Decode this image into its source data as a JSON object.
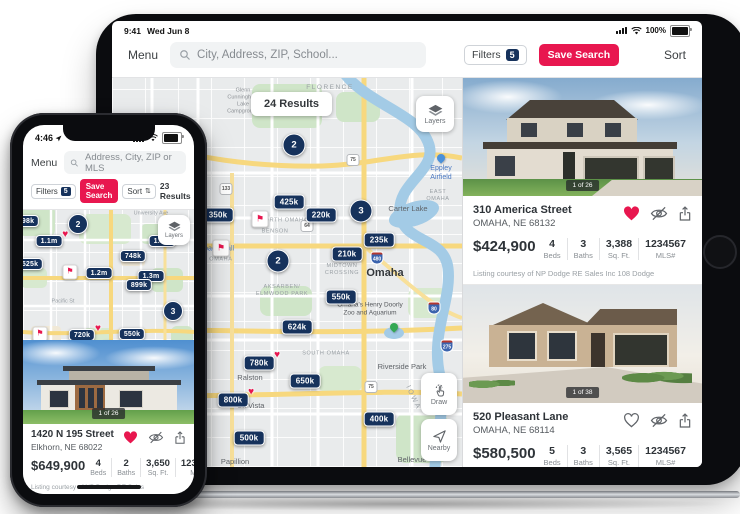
{
  "icons": {
    "sort_arrows": "⇅",
    "flag": "⚑",
    "heart": "♥"
  },
  "colors": {
    "navy": "#16325c",
    "red": "#e8174f",
    "map_water": "#a3cbe6",
    "map_highway": "#f7d87e"
  },
  "ipad": {
    "status": {
      "time": "9:41",
      "date": "Wed Jun 8",
      "battery_pct": "100%"
    },
    "nav": {
      "menu": "Menu",
      "search_placeholder": "City, Address, ZIP, School...",
      "filters": "Filters",
      "filters_count": "5",
      "save_search": "Save Search",
      "sort": "Sort"
    },
    "map": {
      "results": "24 Results",
      "layers": "Layers",
      "draw": "Draw",
      "nearby": "Nearby",
      "pins": [
        {
          "type": "cluster",
          "label": "2",
          "x": 182,
          "y": 67
        },
        {
          "type": "price",
          "label": "425k",
          "x": 177,
          "y": 124
        },
        {
          "type": "price",
          "label": "350k",
          "x": 106,
          "y": 137
        },
        {
          "type": "flag",
          "x": 148,
          "y": 141
        },
        {
          "type": "price",
          "label": "220k",
          "x": 209,
          "y": 137
        },
        {
          "type": "cluster",
          "label": "3",
          "x": 249,
          "y": 133
        },
        {
          "type": "price",
          "label": "235k",
          "x": 267,
          "y": 162
        },
        {
          "type": "price",
          "label": "210k",
          "x": 235,
          "y": 176
        },
        {
          "type": "flag",
          "x": 109,
          "y": 170
        },
        {
          "type": "cluster",
          "label": "2",
          "x": 166,
          "y": 183
        },
        {
          "type": "price",
          "label": "550k",
          "x": 229,
          "y": 219
        },
        {
          "type": "price",
          "label": "624k",
          "x": 185,
          "y": 249
        },
        {
          "type": "price",
          "label": "780k",
          "x": 147,
          "y": 285,
          "fav": true
        },
        {
          "type": "price",
          "label": "650k",
          "x": 193,
          "y": 303
        },
        {
          "type": "price",
          "label": "800k",
          "x": 121,
          "y": 322,
          "fav": true
        },
        {
          "type": "price",
          "label": "400k",
          "x": 267,
          "y": 341
        },
        {
          "type": "price",
          "label": "500k",
          "x": 137,
          "y": 360
        },
        {
          "type": "poi-blue",
          "x": 329,
          "y": 84
        },
        {
          "type": "poi-green",
          "x": 282,
          "y": 253
        }
      ],
      "labels": [
        {
          "text": "Glenn\nCunningham\nLake\nCampground",
          "x": 131,
          "y": 24,
          "cls": "t-place-sm"
        },
        {
          "text": "FLORENCE",
          "x": 218,
          "y": 10,
          "cls": "t-area"
        },
        {
          "text": "Eppley\nAirfield",
          "x": 329,
          "y": 95,
          "cls": "t-poi-blue"
        },
        {
          "text": "Carter Lake",
          "x": 296,
          "y": 131,
          "cls": "t-place"
        },
        {
          "text": "EAST OMAHA",
          "x": 326,
          "y": 118,
          "cls": "t-area-sm"
        },
        {
          "text": "NORTH OMAHA",
          "x": 172,
          "y": 143,
          "cls": "t-area-sm"
        },
        {
          "text": "BENSON",
          "x": 163,
          "y": 154,
          "cls": "t-area-sm"
        },
        {
          "text": "Westroads Mall",
          "x": 98,
          "y": 171,
          "cls": "t-poi-blue"
        },
        {
          "text": "CENTRAL OMAHA",
          "x": 93,
          "y": 182,
          "cls": "t-area-sm"
        },
        {
          "text": "Omaha",
          "x": 273,
          "y": 195,
          "cls": "t-city"
        },
        {
          "text": "MIDTOWN\nCROSSING",
          "x": 230,
          "y": 192,
          "cls": "t-area-sm"
        },
        {
          "text": "AKSARBEN/\nELMWOOD PARK",
          "x": 170,
          "y": 213,
          "cls": "t-area-sm"
        },
        {
          "text": "Omaha's Henry Doorly\nZoo and Aquarium",
          "x": 258,
          "y": 232,
          "cls": "t-poi"
        },
        {
          "text": "SOUTH OMAHA",
          "x": 214,
          "y": 276,
          "cls": "t-area-sm"
        },
        {
          "text": "Riverside Park",
          "x": 290,
          "y": 289,
          "cls": "t-place"
        },
        {
          "text": "Ralston",
          "x": 138,
          "y": 300,
          "cls": "t-place"
        },
        {
          "text": "La Vista",
          "x": 139,
          "y": 328,
          "cls": "t-place"
        },
        {
          "text": "Papillion",
          "x": 123,
          "y": 384,
          "cls": "t-place"
        },
        {
          "text": "Bellevue",
          "x": 300,
          "y": 382,
          "cls": "t-place"
        },
        {
          "text": "IOWA",
          "x": 301,
          "y": 320,
          "cls": "t-state",
          "rot": 65
        }
      ],
      "shields": [
        {
          "n": "680",
          "kind": "i",
          "x": 188,
          "y": 23
        },
        {
          "n": "75",
          "kind": "us",
          "x": 241,
          "y": 82
        },
        {
          "n": "133",
          "kind": "us",
          "x": 114,
          "y": 111
        },
        {
          "n": "64",
          "kind": "us",
          "x": 195,
          "y": 148
        },
        {
          "n": "480",
          "kind": "i",
          "x": 265,
          "y": 180
        },
        {
          "n": "75",
          "kind": "us",
          "x": 259,
          "y": 309
        },
        {
          "n": "80",
          "kind": "i",
          "x": 322,
          "y": 230
        },
        {
          "n": "275",
          "kind": "i",
          "x": 335,
          "y": 268
        }
      ]
    },
    "cards": [
      {
        "photo_counter": "1 of 26",
        "address": "310 America Street",
        "city": "OMAHA, NE 68132",
        "price": "$424,900",
        "stats": [
          {
            "value": "4",
            "label": "Beds"
          },
          {
            "value": "3",
            "label": "Baths"
          },
          {
            "value": "3,388",
            "label": "Sq. Ft."
          },
          {
            "value": "1234567",
            "label": "MLS#"
          }
        ],
        "courtesy": "Listing courtesy of NP Dodge RE Sales Inc 108 Dodge"
      },
      {
        "photo_counter": "1 of 38",
        "address": "520 Pleasant Lane",
        "city": "OMAHA, NE 68114",
        "price": "$580,500",
        "stats": [
          {
            "value": "5",
            "label": "Beds"
          },
          {
            "value": "3",
            "label": "Baths"
          },
          {
            "value": "3,565",
            "label": "Sq. Ft."
          },
          {
            "value": "1234567",
            "label": "MLS#"
          }
        ],
        "courtesy": "Listing courtesy of NP Dodge RE Sales Inc 108 Dodge"
      }
    ]
  },
  "iphone": {
    "status": {
      "time": "4:46"
    },
    "nav": {
      "menu": "Menu",
      "search_placeholder": "Address, City, ZIP or MLS"
    },
    "toolbar": {
      "filters": "Filters",
      "filters_count": "5",
      "save_search": "Save Search",
      "sort": "Sort",
      "results": "23 Results"
    },
    "map": {
      "layers": "Layers",
      "pins": [
        {
          "type": "price",
          "label": "498k",
          "x": 3,
          "y": 11
        },
        {
          "type": "cluster",
          "label": "2",
          "x": 55,
          "y": 14
        },
        {
          "type": "price",
          "label": "1.1m",
          "x": 26,
          "y": 31,
          "fav": true
        },
        {
          "type": "price",
          "label": "1.6m",
          "x": 139,
          "y": 31
        },
        {
          "type": "price",
          "label": "748k",
          "x": 110,
          "y": 46
        },
        {
          "type": "price",
          "label": "525k",
          "x": 7,
          "y": 54
        },
        {
          "type": "flag",
          "x": 47,
          "y": 62
        },
        {
          "type": "price",
          "label": "1.2m",
          "x": 76,
          "y": 63
        },
        {
          "type": "price",
          "label": "1.3m",
          "x": 128,
          "y": 66
        },
        {
          "type": "price",
          "label": "899k",
          "x": 116,
          "y": 75
        },
        {
          "type": "cluster",
          "label": "3",
          "x": 150,
          "y": 101
        },
        {
          "type": "flag",
          "x": 17,
          "y": 124
        },
        {
          "type": "price",
          "label": "720k",
          "x": 59,
          "y": 125,
          "fav": true
        },
        {
          "type": "price",
          "label": "550k",
          "x": 109,
          "y": 124
        },
        {
          "type": "price",
          "label": "430k",
          "x": 92,
          "y": 137
        }
      ],
      "labels": [
        {
          "text": "University Ave",
          "x": 128,
          "y": 4,
          "cls": "t-road"
        },
        {
          "text": "Pacific St",
          "x": 40,
          "y": 92,
          "cls": "t-road"
        }
      ],
      "shields": []
    },
    "card": {
      "photo_counter": "1 of 26",
      "address": "1420 N 195 Street",
      "city": "Elkhorn, NE 68022",
      "price": "$649,900",
      "stats": [
        {
          "value": "4",
          "label": "Beds"
        },
        {
          "value": "2",
          "label": "Baths"
        },
        {
          "value": "3,650",
          "label": "Sq. Ft."
        },
        {
          "value": "1234567",
          "label": "MLS#"
        }
      ],
      "courtesy": "Listing courtesy of NP Dodge RE Sales"
    }
  }
}
